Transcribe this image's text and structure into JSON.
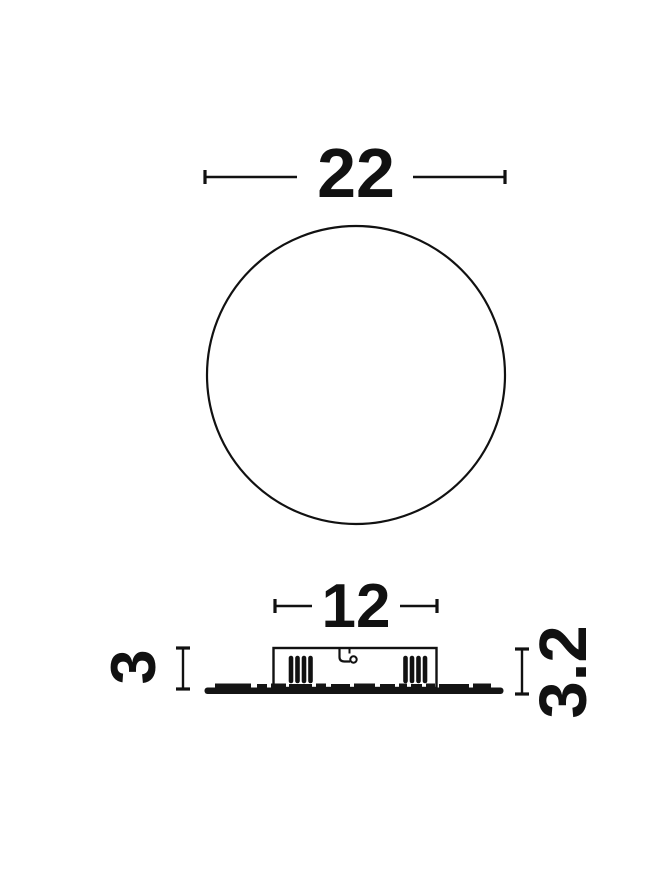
{
  "drawing": {
    "kind": "product-dimension-drawing",
    "dimensions": {
      "diameter": "22",
      "housing_width": "12",
      "housing_height": "3",
      "overall_height": "3.2"
    },
    "colors": {
      "line": "#111111",
      "background": "#ffffff"
    }
  }
}
